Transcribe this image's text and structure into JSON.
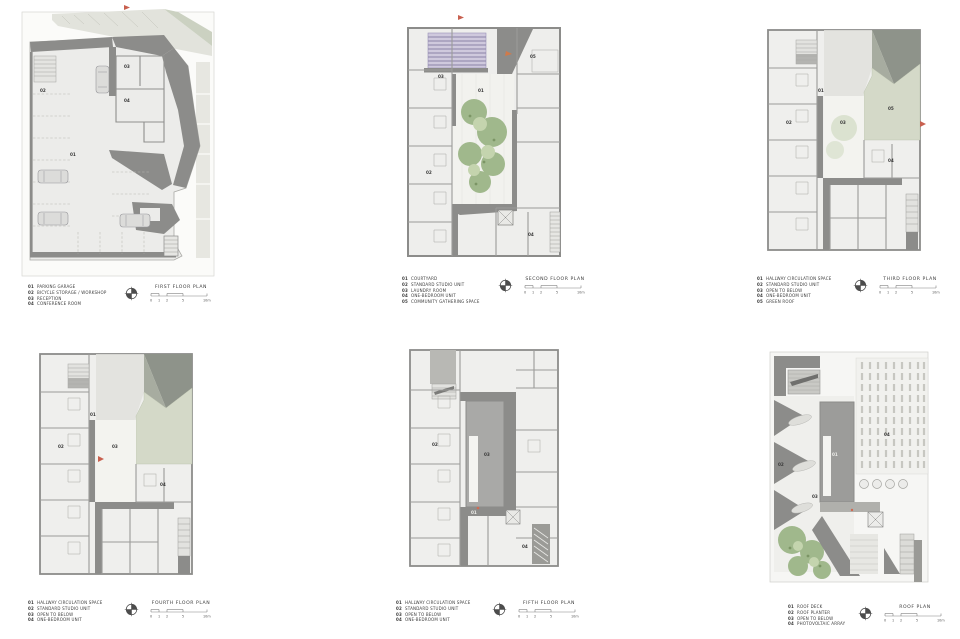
{
  "sheet_title": "Residential building floor plans sheet",
  "scale_labels": [
    "0",
    "1",
    "2",
    "5",
    "10m"
  ],
  "colors": {
    "wall_gray": "#8c8c8a",
    "floor_gray": "#ececea",
    "green_roof": "#d4d9c8",
    "tree_green": "#a0b88c",
    "louver_lavender": "#cfc9dd",
    "marker_red": "#c8604f"
  },
  "plans": [
    {
      "key": "first-floor",
      "title": "FIRST FLOOR PLAN",
      "legend": [
        {
          "num": "01",
          "label": "PARKING GARAGE"
        },
        {
          "num": "02",
          "label": "BICYCLE STORAGE / WORKSHOP"
        },
        {
          "num": "03",
          "label": "RECEPTION"
        },
        {
          "num": "04",
          "label": "CONFERENCE ROOM"
        }
      ]
    },
    {
      "key": "second-floor",
      "title": "SECOND FLOOR PLAN",
      "legend": [
        {
          "num": "01",
          "label": "COURTYARD"
        },
        {
          "num": "02",
          "label": "STANDARD STUDIO UNIT"
        },
        {
          "num": "03",
          "label": "LAUNDRY ROOM"
        },
        {
          "num": "04",
          "label": "ONE-BEDROOM UNIT"
        },
        {
          "num": "05",
          "label": "COMMUNITY GATHERING SPACE"
        }
      ]
    },
    {
      "key": "third-floor",
      "title": "THIRD FLOOR PLAN",
      "legend": [
        {
          "num": "01",
          "label": "HALLWAY CIRCULATION SPACE"
        },
        {
          "num": "02",
          "label": "STANDARD STUDIO UNIT"
        },
        {
          "num": "03",
          "label": "OPEN TO BELOW"
        },
        {
          "num": "04",
          "label": "ONE-BEDROOM UNIT"
        },
        {
          "num": "05",
          "label": "GREEN ROOF"
        }
      ]
    },
    {
      "key": "fourth-floor",
      "title": "FOURTH FLOOR PLAN",
      "legend": [
        {
          "num": "01",
          "label": "HALLWAY CIRCULATION SPACE"
        },
        {
          "num": "02",
          "label": "STANDARD STUDIO UNIT"
        },
        {
          "num": "03",
          "label": "OPEN TO BELOW"
        },
        {
          "num": "04",
          "label": "ONE-BEDROOM UNIT"
        }
      ]
    },
    {
      "key": "fifth-floor",
      "title": "FIFTH FLOOR PLAN",
      "legend": [
        {
          "num": "01",
          "label": "HALLWAY CIRCULATION SPACE"
        },
        {
          "num": "02",
          "label": "STANDARD STUDIO UNIT"
        },
        {
          "num": "03",
          "label": "OPEN TO BELOW"
        },
        {
          "num": "04",
          "label": "ONE-BEDROOM UNIT"
        }
      ]
    },
    {
      "key": "roof",
      "title": "ROOF PLAN",
      "legend": [
        {
          "num": "01",
          "label": "ROOF DECK"
        },
        {
          "num": "02",
          "label": "ROOF PLANTER"
        },
        {
          "num": "03",
          "label": "OPEN TO BELOW"
        },
        {
          "num": "04",
          "label": "PHOTOVOLTAIC ARRAY"
        }
      ]
    }
  ]
}
